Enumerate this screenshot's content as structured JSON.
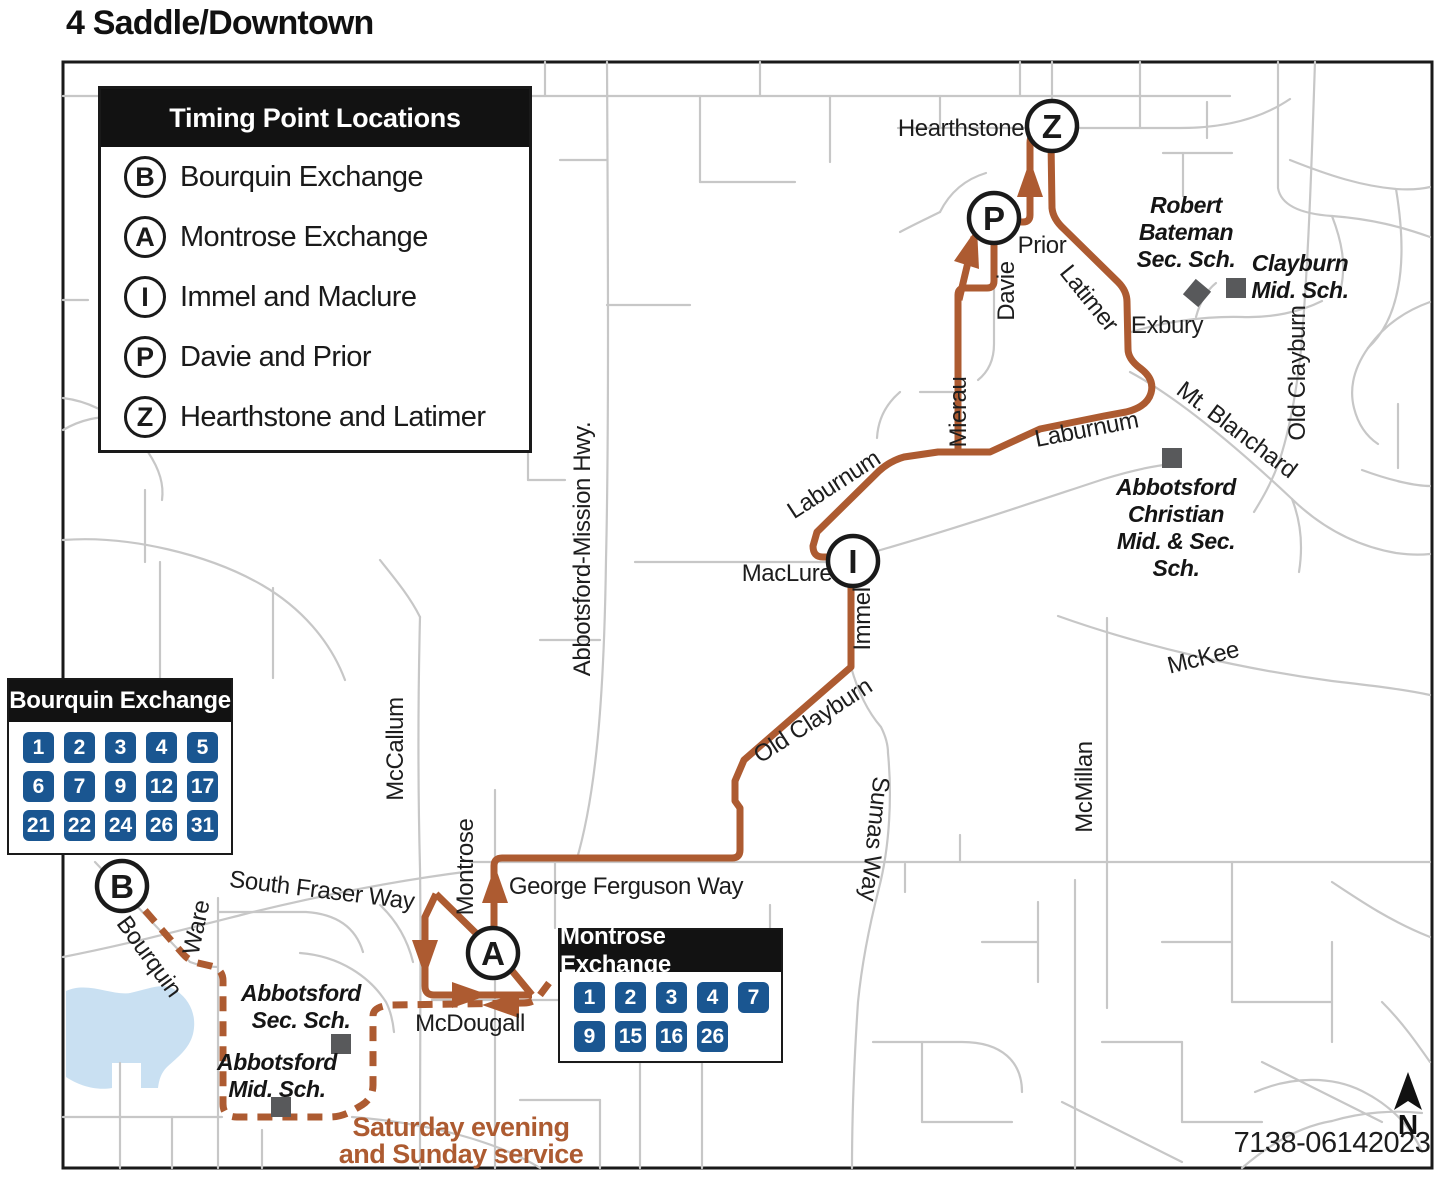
{
  "title": "4 Saddle/Downtown",
  "colors": {
    "route": "#AD5B31",
    "badge_blue": "#1A5691",
    "street_gray": "#C7C7C7",
    "lake_blue": "#C9E0F2",
    "school_gray": "#58595B",
    "panel_black": "#121212"
  },
  "legend": {
    "title": "Timing Point Locations",
    "items": [
      {
        "letter": "B",
        "label": "Bourquin Exchange"
      },
      {
        "letter": "A",
        "label": "Montrose Exchange"
      },
      {
        "letter": "I",
        "label": "Immel and Maclure"
      },
      {
        "letter": "P",
        "label": "Davie and Prior"
      },
      {
        "letter": "Z",
        "label": "Hearthstone and Latimer"
      }
    ]
  },
  "exchanges": {
    "bourquin": {
      "title": "Bourquin Exchange",
      "rows": [
        [
          "1",
          "2",
          "3",
          "4",
          "5"
        ],
        [
          "6",
          "7",
          "9",
          "12",
          "17"
        ],
        [
          "21",
          "22",
          "24",
          "26",
          "31"
        ]
      ]
    },
    "montrose": {
      "title": "Montrose Exchange",
      "rows": [
        [
          "1",
          "2",
          "3",
          "4",
          "7"
        ],
        [
          "9",
          "15",
          "16",
          "26"
        ]
      ]
    }
  },
  "map": {
    "timing_points": [
      {
        "letter": "B",
        "x": 122,
        "y": 886
      },
      {
        "letter": "A",
        "x": 493,
        "y": 953
      },
      {
        "letter": "I",
        "x": 853,
        "y": 561
      },
      {
        "letter": "P",
        "x": 994,
        "y": 218
      },
      {
        "letter": "Z",
        "x": 1052,
        "y": 126
      }
    ],
    "street_labels": [
      {
        "text": "Hearthstone",
        "x": 961,
        "y": 136,
        "rot": 0
      },
      {
        "text": "Prior",
        "x": 1042,
        "y": 253,
        "rot": 0
      },
      {
        "text": "Davie",
        "x": 1014,
        "y": 291,
        "rot": -90
      },
      {
        "text": "Latimer",
        "x": 1083,
        "y": 303,
        "rot": 51
      },
      {
        "text": "Exbury",
        "x": 1167,
        "y": 333,
        "rot": 0
      },
      {
        "text": "Mierau",
        "x": 966,
        "y": 412,
        "rot": -90
      },
      {
        "text": "Laburnum",
        "x": 838,
        "y": 491,
        "rot": -33
      },
      {
        "text": "Laburnum",
        "x": 1088,
        "y": 437,
        "rot": -11
      },
      {
        "text": "Mt. Blanchard",
        "x": 1232,
        "y": 436,
        "rot": 37
      },
      {
        "text": "Old Clayburn",
        "x": 1305,
        "y": 373,
        "rot": -90
      },
      {
        "text": "McKee",
        "x": 1205,
        "y": 665,
        "rot": -14
      },
      {
        "text": "MacLure",
        "x": 787,
        "y": 581,
        "rot": 0
      },
      {
        "text": "Immel",
        "x": 870,
        "y": 619,
        "rot": -90
      },
      {
        "text": "Old Clayburn",
        "x": 817,
        "y": 727,
        "rot": -33
      },
      {
        "text": "Sumas Way",
        "x": 867,
        "y": 838,
        "rot": 96
      },
      {
        "text": "McMillan",
        "x": 1092,
        "y": 787,
        "rot": -90
      },
      {
        "text": "Abbotsford-Mission Hwy.",
        "x": 590,
        "y": 549,
        "rot": -90
      },
      {
        "text": "McCallum",
        "x": 403,
        "y": 749,
        "rot": -90
      },
      {
        "text": "Montrose",
        "x": 473,
        "y": 867,
        "rot": -90
      },
      {
        "text": "George Ferguson Way",
        "x": 626,
        "y": 894,
        "rot": 0
      },
      {
        "text": "South Fraser Way",
        "x": 321,
        "y": 898,
        "rot": 7
      },
      {
        "text": "Ware",
        "x": 204,
        "y": 929,
        "rot": -78
      },
      {
        "text": "Bourquin",
        "x": 143,
        "y": 961,
        "rot": 54
      },
      {
        "text": "McDougall",
        "x": 470,
        "y": 1031,
        "rot": 0
      }
    ],
    "schools": [
      {
        "lines": [
          "Robert",
          "Bateman",
          "Sec. Sch."
        ],
        "x": 1186,
        "y": 213,
        "marker": {
          "x": 1197,
          "y": 293,
          "rot": 40
        }
      },
      {
        "lines": [
          "Clayburn",
          "Mid. Sch."
        ],
        "x": 1300,
        "y": 271,
        "marker": {
          "x": 1236,
          "y": 288,
          "rot": 0
        }
      },
      {
        "lines": [
          "Abbotsford",
          "Christian",
          "Mid. & Sec.",
          "Sch."
        ],
        "x": 1176,
        "y": 495,
        "marker": {
          "x": 1172,
          "y": 458,
          "rot": 0
        }
      },
      {
        "lines": [
          "Abbotsford",
          "Sec. Sch."
        ],
        "x": 301,
        "y": 1001,
        "marker": {
          "x": 341,
          "y": 1044,
          "rot": 0
        }
      },
      {
        "lines": [
          "Abbotsford",
          "Mid. Sch."
        ],
        "x": 277,
        "y": 1070,
        "marker": {
          "x": 281,
          "y": 1107,
          "rot": 0
        }
      }
    ],
    "service_note": {
      "lines": [
        "Saturday evening",
        "and Sunday service"
      ],
      "x": 461,
      "y": 1136,
      "line_height": 27
    },
    "plate": "7138-06142023",
    "north_label": "N"
  }
}
